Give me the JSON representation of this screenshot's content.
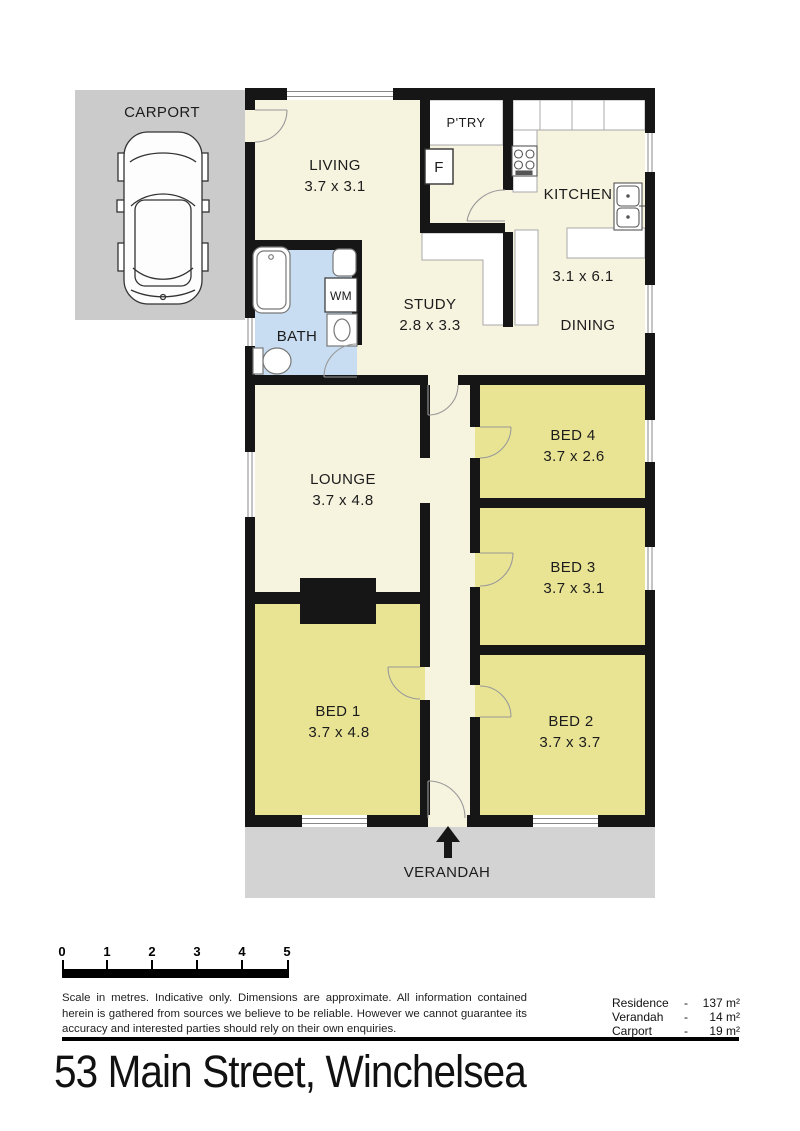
{
  "address": "53 Main Street, Winchelsea",
  "floorplan": {
    "carport": {
      "label": "CARPORT"
    },
    "living": {
      "label": "LIVING",
      "dims": "3.7 x 3.1"
    },
    "pantry": {
      "label": "P'TRY"
    },
    "fridge": {
      "label": "F"
    },
    "kitchen": {
      "label": "KITCHEN"
    },
    "kitchen_dining": {
      "dims": "3.1 x 6.1"
    },
    "dining": {
      "label": "DINING"
    },
    "bath": {
      "label": "BATH"
    },
    "washing_machine": {
      "label": "WM"
    },
    "study": {
      "label": "STUDY",
      "dims": "2.8 x 3.3"
    },
    "lounge": {
      "label": "LOUNGE",
      "dims": "3.7 x 4.8"
    },
    "bed1": {
      "label": "BED 1",
      "dims": "3.7 x 4.8"
    },
    "bed2": {
      "label": "BED 2",
      "dims": "3.7 x 3.7"
    },
    "bed3": {
      "label": "BED 3",
      "dims": "3.7 x 3.1"
    },
    "bed4": {
      "label": "BED 4",
      "dims": "3.7 x 2.6"
    },
    "verandah": {
      "label": "VERANDAH"
    }
  },
  "scale_bar": {
    "ticks": [
      "0",
      "1",
      "2",
      "3",
      "4",
      "5"
    ]
  },
  "disclaimer": "Scale in metres. Indicative only. Dimensions are approximate. All information contained herein is gathered from sources we believe to be reliable. However we cannot guarantee its accuracy and interested parties should rely on their own enquiries.",
  "areas": {
    "separator": "-",
    "rows": [
      {
        "label": "Residence",
        "value": "137 m²"
      },
      {
        "label": "Verandah",
        "value": "14 m²"
      },
      {
        "label": "Carport",
        "value": "19 m²"
      }
    ]
  },
  "colors": {
    "floor_cream": "#f6f3df",
    "bedroom_yellow": "#e9e494",
    "bath_blue": "#c8ddf1",
    "carport_grey": "#cbcbcb",
    "verandah_grey": "#d3d3d3",
    "wall_black": "#161616"
  }
}
